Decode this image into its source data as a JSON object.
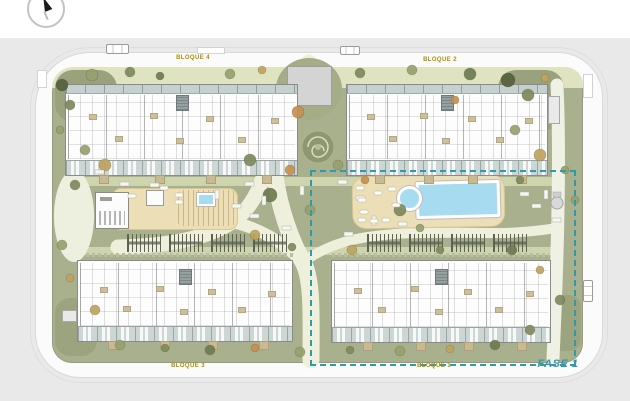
{
  "plan": {
    "title": "residential complex site plan",
    "phase": {
      "label": "FASE 1"
    },
    "blocks": [
      {
        "id": "bloque-4",
        "label": "BLOQUE 4"
      },
      {
        "id": "bloque-2",
        "label": "BLOQUE 2"
      },
      {
        "id": "bloque-3",
        "label": "BLOQUE 3"
      },
      {
        "id": "bloque-1",
        "label": "BLOQUE 1"
      }
    ],
    "icons": {
      "compass": "compass-north-icon"
    },
    "colors": {
      "site_green": "#a9b08d",
      "path_cream": "#eef0dc",
      "deck_sand": "#ecdeb6",
      "pool_water": "#a6dbf0",
      "road_white": "#fbfbfc",
      "terrace_blue": "#ccd7d5",
      "label_yellow": "#b08d00",
      "phase_teal": "#2f9aae",
      "wall_gray": "#8a8a8a",
      "pergola_dark": "#5c6254"
    }
  }
}
